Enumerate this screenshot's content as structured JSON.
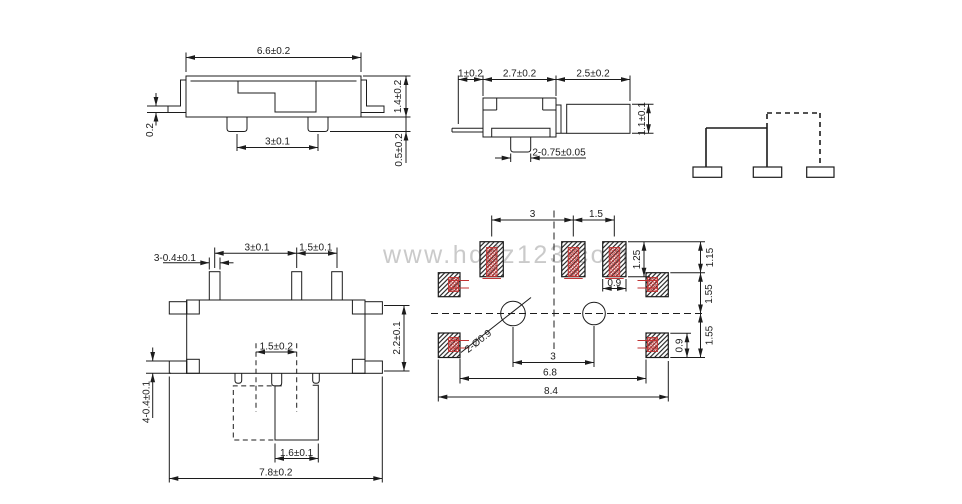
{
  "watermark": "www.hqdz123.com",
  "colors": {
    "line": "#1c1c1c",
    "accent_red": "#c13333",
    "watermark": "#cacaca",
    "background": "#ffffff"
  },
  "side_view": {
    "body_width": "6.6±0.2",
    "body_height": "1.4±0.2",
    "lead_thickness": "0.2",
    "pin_pitch": "3±0.1",
    "pin_standoff": "0.5±0.2"
  },
  "end_view": {
    "lead_length": "1±0.2",
    "body_width": "2.7±0.2",
    "knob_length": "2.5±0.2",
    "knob_height": "1.1±0.1",
    "pin_spec": "2-0.75±0.05"
  },
  "top_view": {
    "pin_spec": "3-0.4±0.1",
    "pin_pitch_a": "3±0.1",
    "pin_pitch_b": "1.5±0.1",
    "body_depth": "2.2±0.1",
    "knob_travel": "1.5±0.2",
    "knob_width": "1.6±0.1",
    "tab_spec": "4-0.4±0.1",
    "overall_width": "7.8±0.2"
  },
  "pcb_view": {
    "pad_pitch_a": "3",
    "pad_pitch_b": "1.5",
    "pad_length": "1.25",
    "row_gap": "1.15",
    "gap_upper": "1.55",
    "gap_lower": "1.55",
    "pad_width": "0.9",
    "side_pad_height": "0.9",
    "hole_spec": "2-Ø0.9",
    "hole_pitch": "3",
    "inner_span": "6.8",
    "overall_span": "8.4"
  }
}
